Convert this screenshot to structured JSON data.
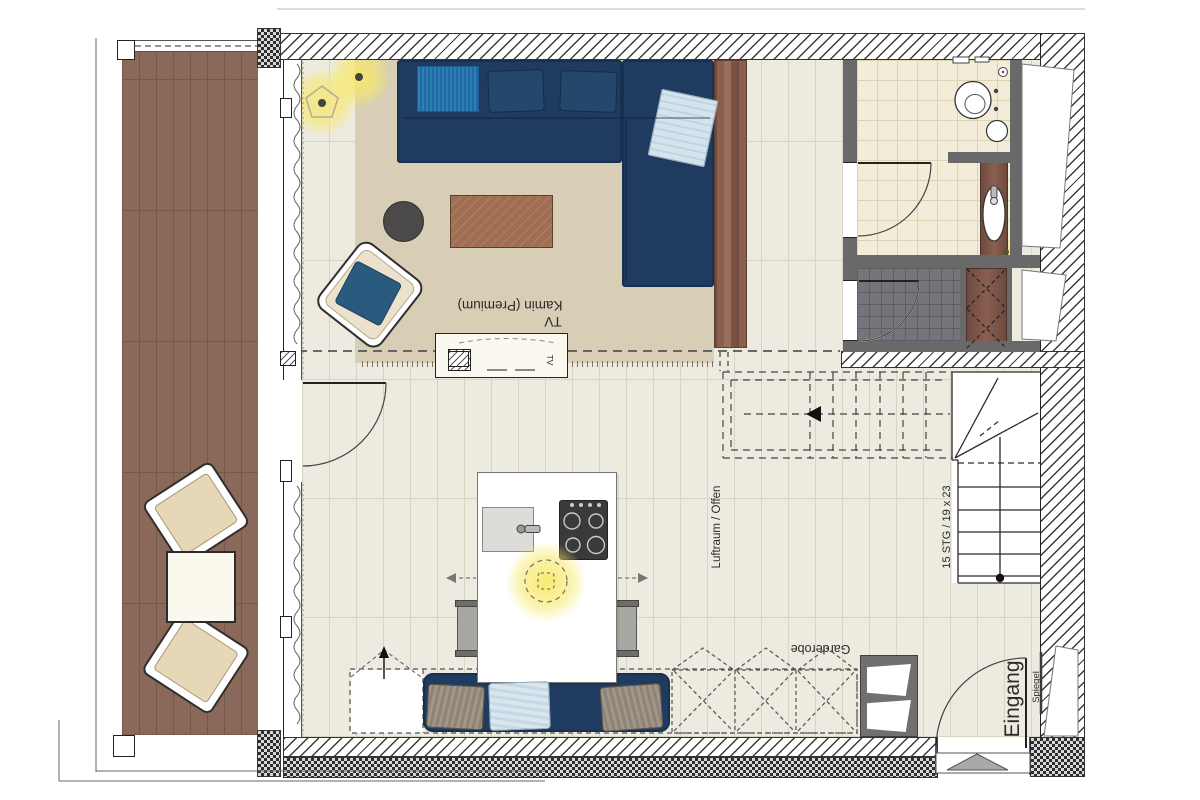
{
  "labels": {
    "kamin_premium": "Kamin (Premium)",
    "tv": "TV",
    "tv_unit": "TV",
    "luftraum": "Luftraum / Offen",
    "stairs_note": "15 STG / 19 x 23",
    "garderobe": "Garderobe",
    "eingang": "Eingang",
    "spiegel": "Spiegel"
  },
  "colors": {
    "deck_wood": "#8b695a",
    "deck_line": "#74584a",
    "floor": "#edeadf",
    "floor_line": "#d8d3c2",
    "rug": "#d7ceb5",
    "sofa_navy": "#1f3c60",
    "sofa_edge": "#16304f",
    "throw_blue": "#2b7fb8",
    "blanket_blue": "#d5e3ed",
    "pillow_taupe": "#9b8e80",
    "coffee_table": "#a06e53",
    "partition_wood": "#84594a",
    "bath_tile": "#f3ecd8",
    "bath_tile_line": "#dcd2b4",
    "shower_tile": "#74747b",
    "shower_tile_line": "#5e5e66",
    "wall_gray": "#696969",
    "closet_wood": "#7c5546",
    "glow_yellow": "#f1e478",
    "cooktop_dark": "#3a3a3a"
  }
}
